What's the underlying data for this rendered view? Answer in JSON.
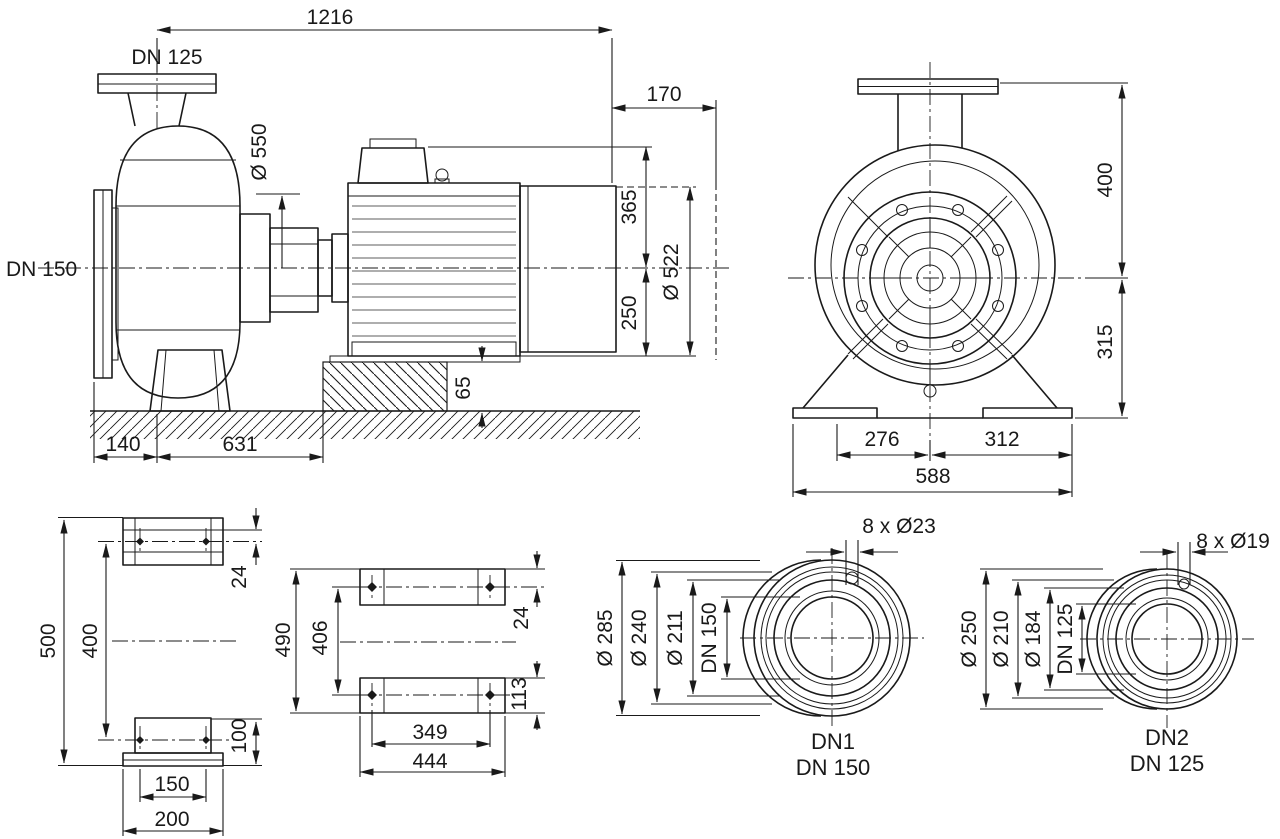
{
  "side": {
    "total_length": "1216",
    "discharge_dn": "DN 125",
    "suction_dn": "DN 150",
    "dia550": "Ø 550",
    "overhang": "170",
    "h365": "365",
    "dia522": "Ø 522",
    "h250": "250",
    "h65": "65",
    "w140": "140",
    "w631": "631"
  },
  "front": {
    "h400": "400",
    "h315": "315",
    "w276": "276",
    "w312": "312",
    "w588": "588"
  },
  "plan": {
    "h500": "500",
    "h400": "400",
    "t24": "24",
    "h100": "100",
    "w150": "150",
    "w200": "200"
  },
  "feet": {
    "h490": "490",
    "h406": "406",
    "t24": "24",
    "h113": "113",
    "w349": "349",
    "w444": "444"
  },
  "flange1": {
    "bolts": "8 x Ø23",
    "outer": "Ø 285",
    "bolt_circle": "Ø 240",
    "raised": "Ø 211",
    "bore": "DN 150",
    "cap1": "DN1",
    "cap2": "DN 150"
  },
  "flange2": {
    "bolts": "8 x Ø19",
    "outer": "Ø 250",
    "bolt_circle": "Ø 210",
    "raised": "Ø 184",
    "bore": "DN 125",
    "cap1": "DN2",
    "cap2": "DN 125"
  },
  "colors": {
    "line": "#1a1a1a",
    "background": "#ffffff"
  }
}
